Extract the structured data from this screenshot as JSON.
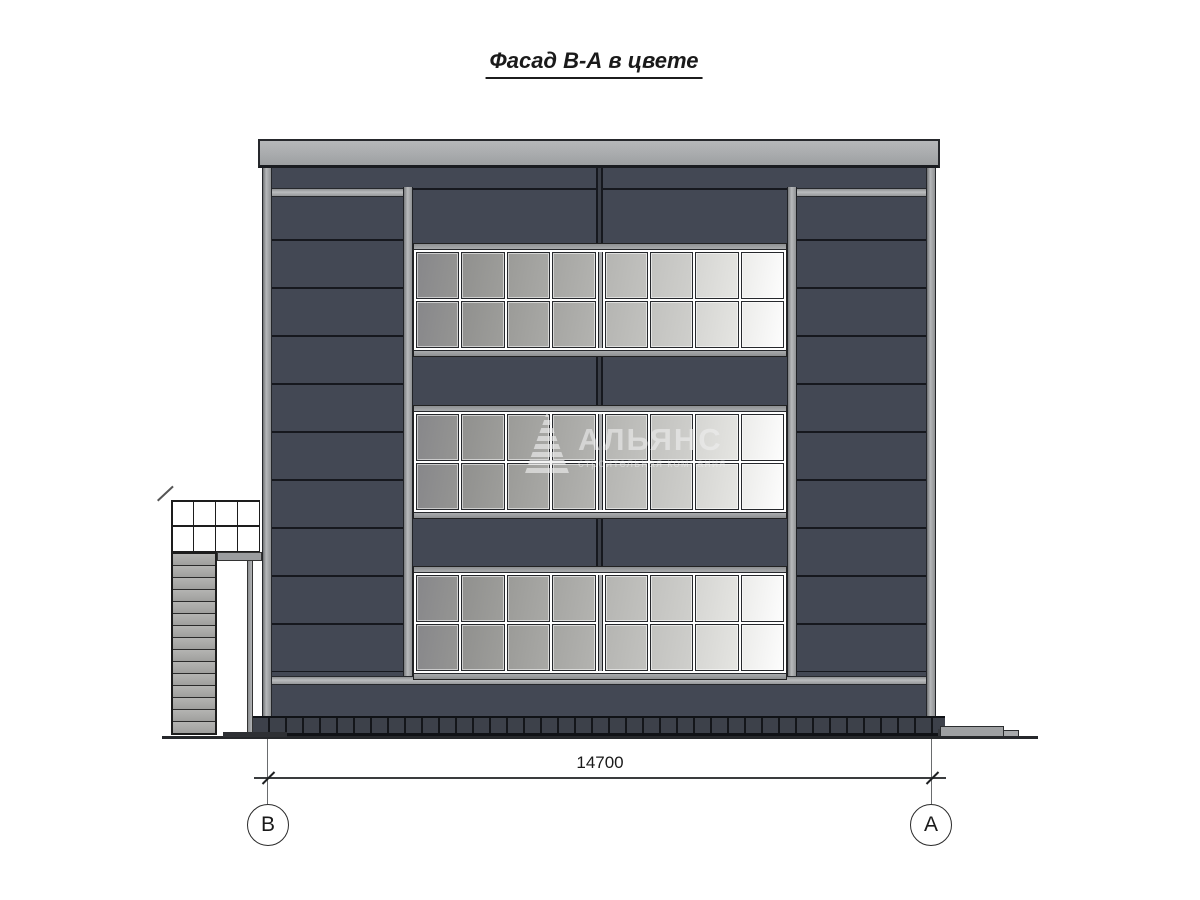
{
  "title": "Фасад В-А в цвете",
  "drawing": {
    "dimension_label": "14700",
    "axis_left": "В",
    "axis_right": "А"
  },
  "watermark": {
    "name": "АЛЬЯНС",
    "subtitle": "строительная компания",
    "logo": "striped-triangle-a-icon"
  },
  "building": {
    "band_count": 3,
    "window_columns": 8,
    "window_rows": 2,
    "pane_colors": [
      {
        "from": "#87878a",
        "to": "#959593"
      },
      {
        "from": "#90908e",
        "to": "#9e9e9b"
      },
      {
        "from": "#9b9b98",
        "to": "#a9a9a6"
      },
      {
        "from": "#a5a5a2",
        "to": "#b3b3b0"
      },
      {
        "from": "#b5b5b2",
        "to": "#c2c2bf"
      },
      {
        "from": "#c2c2bf",
        "to": "#cfcfcc"
      },
      {
        "from": "#d5d5d2",
        "to": "#e5e5e2"
      },
      {
        "from": "#ebebe9",
        "to": "#fdfdfd"
      }
    ],
    "colors": {
      "facade_panel": "#434854",
      "panel_seam": "#16181e",
      "metal_trim": "#a7a9ab",
      "plinth": "#3d414a",
      "glass_darkest": "#87878a",
      "glass_lightest": "#fdfdfd"
    }
  },
  "annex": {
    "grid_cols": 4,
    "grid_rows": 2,
    "strip_count": 15
  }
}
